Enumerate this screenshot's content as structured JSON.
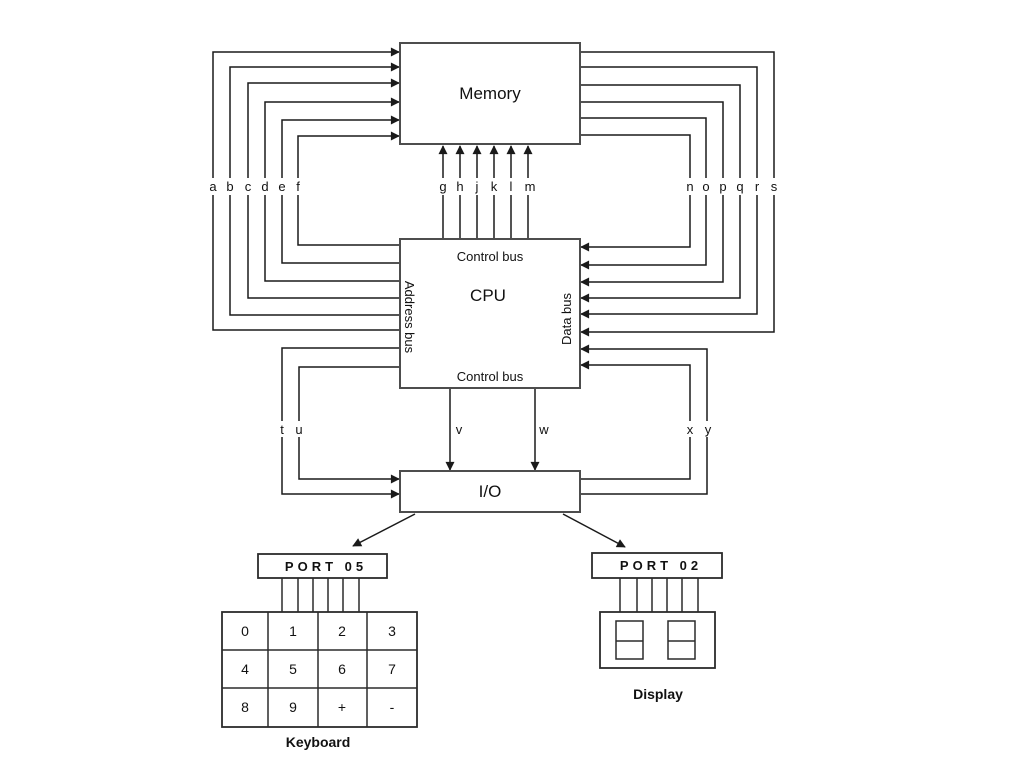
{
  "diagram": {
    "memory_label": "Memory",
    "cpu_label": "CPU",
    "io_label": "I/O",
    "control_bus_top_label": "Control bus",
    "control_bus_bottom_label": "Control bus",
    "address_bus_label": "Address bus",
    "data_bus_label": "Data bus"
  },
  "bus_letters": {
    "address": [
      "a",
      "b",
      "c",
      "d",
      "e",
      "f"
    ],
    "control_to_memory": [
      "g",
      "h",
      "j",
      "k",
      "l",
      "m"
    ],
    "data": [
      "n",
      "o",
      "p",
      "q",
      "r",
      "s"
    ],
    "io_left": [
      "t",
      "u"
    ],
    "cpu_to_io": [
      "v",
      "w"
    ],
    "io_right": [
      "x",
      "y"
    ]
  },
  "keyboard_port": {
    "label": "PORT 05"
  },
  "display_port": {
    "label": "PORT 02"
  },
  "keyboard": {
    "label": "Keyboard",
    "keys": [
      "0",
      "1",
      "2",
      "3",
      "4",
      "5",
      "6",
      "7",
      "8",
      "9",
      "+",
      "-"
    ]
  },
  "display": {
    "label": "Display"
  },
  "colors": {
    "ink": "#1a1a1a",
    "box_border": "#4d4d4d",
    "background": "#ffffff"
  }
}
